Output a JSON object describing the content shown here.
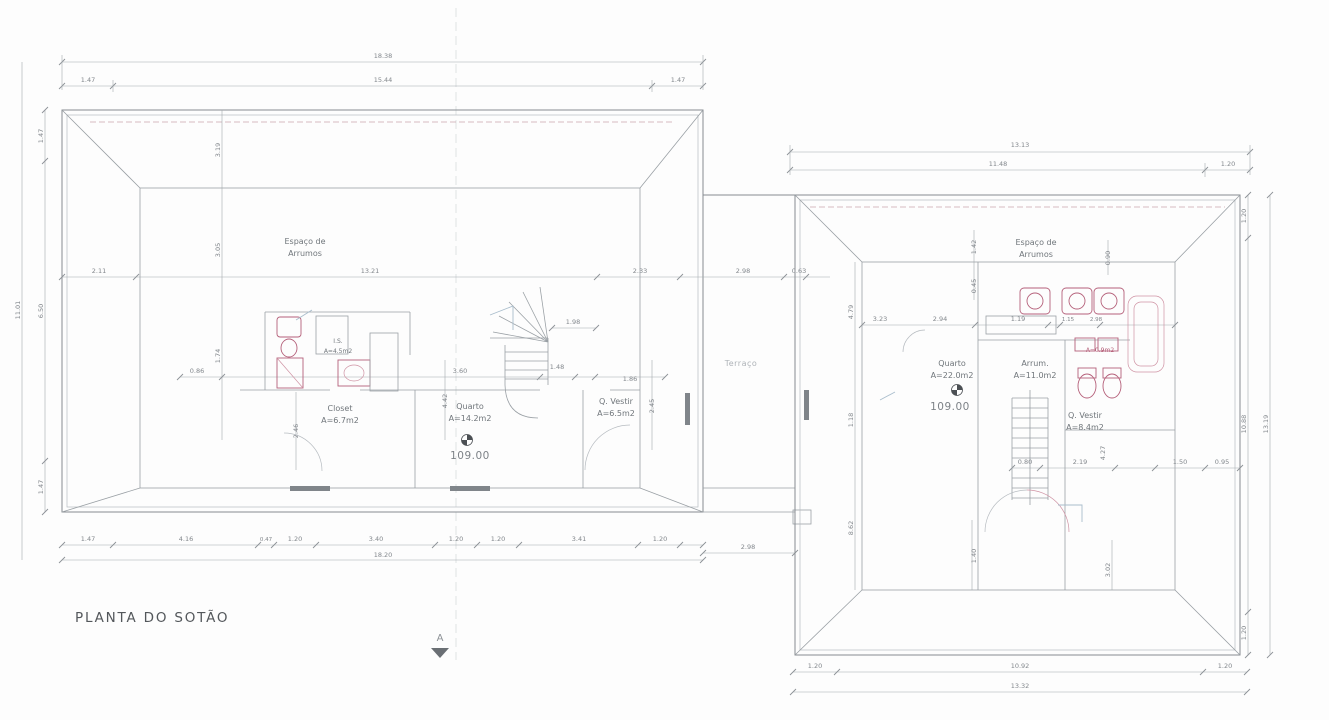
{
  "title": "PLANTA DO SOTÃO",
  "section_marker": "A",
  "terrace_label": "Terraço",
  "accent_colors": {
    "fixture_pink": "#b5607a",
    "wall_grey": "#878c91",
    "dim_grey": "#a4a9ae",
    "dashed_eave_pink": "#c9a6ad",
    "faint_blue": "#a9bdcc",
    "background": "#fdfdfd"
  },
  "left_plan": {
    "rooms": {
      "storage_1": "Espaço de",
      "storage_2": "Arrumos",
      "closet_name": "Closet",
      "closet_area": "A=6.7m2",
      "bedroom_name": "Quarto",
      "bedroom_area": "A=14.2m2",
      "level_value": "109.00",
      "dressing_name": "Q. Vestir",
      "dressing_area": "A=6.5m2",
      "bath_name": "I.S.",
      "bath_area": "A=4.5m2"
    },
    "dims": {
      "top_overall": "18.38",
      "top_left": "1.47",
      "top_mid": "15.44",
      "top_right": "1.47",
      "left_overall": "11.01",
      "left_top": "1.47",
      "left_mid": "6.50",
      "left_bottom": "1.47",
      "mid_1": "2.11",
      "mid_2": "13.21",
      "mid_3": "2.33",
      "mid_4": "2.98",
      "mid_5": "0.63",
      "in_1": "3.19",
      "in_2": "3.05",
      "in_3": "1.74",
      "in_4": "0.86",
      "in_5": "3.60",
      "in_6": "1.48",
      "in_7": "1.86",
      "in_8": "1.98",
      "in_9": "2.46",
      "in_10": "4.42",
      "in_11": "2.45",
      "bot_1": "1.47",
      "bot_2": "4.16",
      "bot_3": "0.47",
      "bot_4": "1.20",
      "bot_5": "3.40",
      "bot_6": "1.20",
      "bot_7": "1.20",
      "bot_8": "3.41",
      "bot_9": "1.20",
      "bot_overall": "18.20",
      "terrace_bottom": "2.98"
    }
  },
  "right_plan": {
    "rooms": {
      "storage_1": "Espaço de",
      "storage_2": "Arrumos",
      "bedroom_name": "Quarto",
      "bedroom_area": "A=22.0m2",
      "level_value": "109.00",
      "storage2_name": "Arrum.",
      "storage2_area": "A=11.0m2",
      "dressing_name": "Q. Vestir",
      "dressing_area": "A=8.4m2",
      "fixture_label": "A=0.9m2"
    },
    "dims": {
      "top_overall": "13.13",
      "top_mid": "11.48",
      "top_right": "1.20",
      "right_top": "1.20",
      "right_mid": "10.88",
      "right_overall": "13.19",
      "right_bottom": "1.20",
      "bot_left": "1.20",
      "bot_mid": "10.92",
      "bot_right": "1.20",
      "bot_overall": "13.32",
      "in_1": "4.79",
      "in_2": "1.18",
      "in_3": "8.62",
      "in_4": "3.23",
      "in_5": "2.94",
      "in_6": "1.19",
      "in_7": "1.15",
      "in_8": "2.98",
      "in_9": "1.42",
      "in_10": "0.45",
      "in_11": "0.90",
      "in_12": "0.80",
      "in_13": "2.19",
      "in_14": "4.27",
      "in_15": "1.50",
      "in_16": "0.95",
      "in_17": "1.40",
      "in_18": "3.02"
    }
  }
}
